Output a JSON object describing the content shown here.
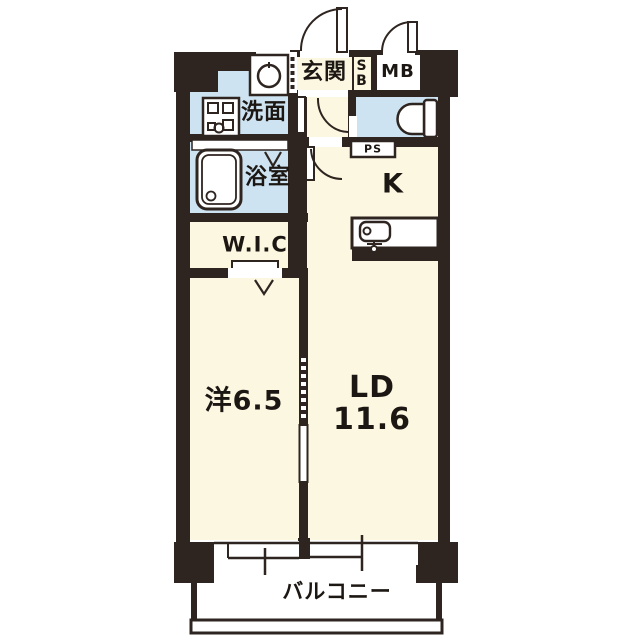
{
  "floorplan": {
    "type": "apartment-1LDK-floor-plan",
    "rooms": {
      "entrance": "玄関",
      "shoe_box": [
        "S",
        "B"
      ],
      "meter_box": "MB",
      "washroom": "洗面",
      "bathroom": "浴室",
      "walk_in_closet": "W.I.C",
      "kitchen": "K",
      "pipe_space": "PS",
      "western_room": "洋6.5",
      "living_dining_line1": "LD",
      "living_dining_line2": "11.6",
      "balcony": "バルコニー"
    },
    "icons": [
      "washing-machine-icon",
      "vanity-icon",
      "bathtub-icon",
      "toilet-icon",
      "kitchen-sink-icon",
      "door-swing-arc-icon",
      "folding-door-v-icon",
      "sliding-window-icon"
    ],
    "colors": {
      "wall": "#2e2420",
      "floor_cream": "#fcf7e1",
      "wet_area_blue": "#cde3f1",
      "white": "#ffffff",
      "text": "#1c1713"
    }
  }
}
